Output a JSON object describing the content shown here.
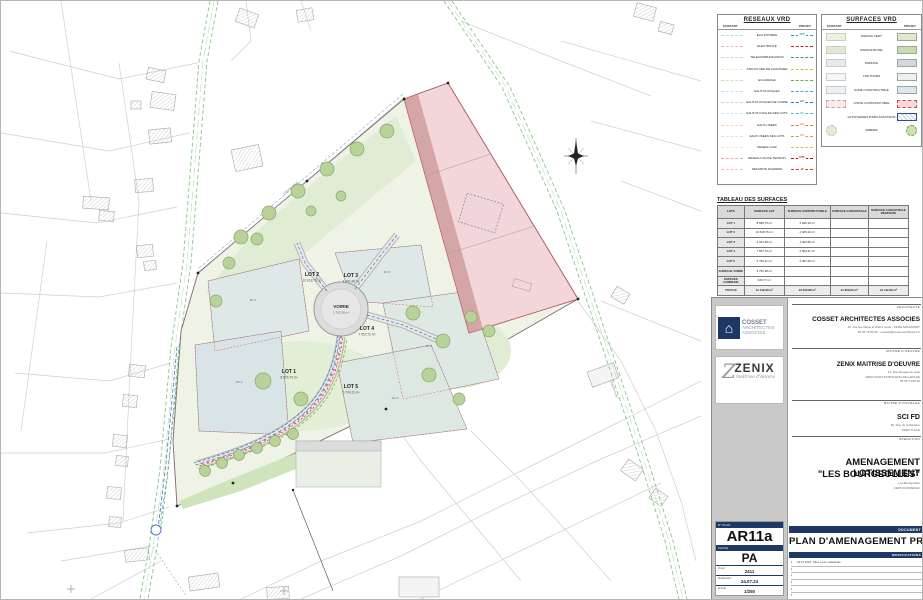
{
  "colors": {
    "navy": "#1e3866",
    "site_green": "#eef3e6",
    "pink_zone": "#f3d6da",
    "zone_blue": "#dde8e7",
    "road_green_dash": "#86c886",
    "network_blue": "#4472c4",
    "network_red": "#cc3333"
  },
  "legend_reseaux": {
    "title": "RESEAUX VRD",
    "col_existant": "EXISTANT",
    "col_projet": "PROJET",
    "rows": [
      {
        "label": "EAU POTABLE",
        "color": "#2aa198",
        "tag": "AEP"
      },
      {
        "label": "ELECTRICITE",
        "color": "#cc2222"
      },
      {
        "label": "TELECOMMUNICATION",
        "color": "#3a9d4e"
      },
      {
        "label": "STRUCTURE DE CHAUSSEE",
        "color": "#d9bb35"
      },
      {
        "label": "ECLAIRAGE",
        "color": "#56b54a"
      },
      {
        "label": "EAUX PLUVIALES",
        "color": "#5b9bd5"
      },
      {
        "label": "EAUX PLUVIALES DE VOIRIE",
        "color": "#2e75b6",
        "tag": "EP"
      },
      {
        "label": "EAUX PLUVIALES DES LOTS",
        "color": "#3ec6d8",
        "tag": "EP"
      },
      {
        "label": "EAUX USEES",
        "color": "#e67e22",
        "tag": "EU"
      },
      {
        "label": "EAUX USEES DES LOTS",
        "color": "#c8a23c",
        "tag": "EU"
      },
      {
        "label": "RESEAU GAZ",
        "color": "#c9c93a"
      },
      {
        "label": "RESEAU HAUTE TENSION",
        "color": "#c00000",
        "tag": "HTA"
      },
      {
        "label": "SECURITE INCENDIE",
        "color": "#e03030",
        "tag": "BI"
      }
    ]
  },
  "legend_surfaces": {
    "title": "SURFACES VRD",
    "col_existant": "EXISTANT",
    "col_projet": "PROJET",
    "rows": [
      {
        "label": "ESPACE VERT"
      },
      {
        "label": "ESPACE BOISE"
      },
      {
        "label": "PARKING"
      },
      {
        "label": "TROTTOIRS"
      },
      {
        "label": "ZONE CONSTRUCTIBLE"
      },
      {
        "label": "LIMITE CONSTRUCTIBLE"
      },
      {
        "label": "HYPOTHESES D'IMPLANTATIONS"
      },
      {
        "label": "ARBRES"
      }
    ]
  },
  "table": {
    "title": "TABLEAU DES SURFACES",
    "headers": [
      "LOTS",
      "SURFACE LOT",
      "SURFACE CONSTRUCTIBLE",
      "SURFACE CADASTRALE",
      "SURFACE CADASTRALE RESTANTE"
    ],
    "rows": [
      [
        "LOT 1",
        "8 595,75 m²",
        "2 936,20 m²",
        "",
        ""
      ],
      [
        "LOT 2",
        "10 618,75 m²",
        "2 925,23 m²",
        "",
        ""
      ],
      [
        "LOT 3",
        "4 347,48 m²",
        "1 363,58 m²",
        "",
        ""
      ],
      [
        "LOT 4",
        "7 657,72 m²",
        "2 553,21 m²",
        "",
        ""
      ],
      [
        "LOT 5",
        "5 794,11 m²",
        "2 257,66 m²",
        "",
        ""
      ],
      [
        "SURFACE VOIRIE",
        "3 752,38 m²",
        "",
        "",
        ""
      ],
      [
        "ESPACES COMMUNS",
        "646,77 m²",
        "",
        "",
        ""
      ]
    ],
    "total": [
      "TOTAUX",
      "41 412,96 m²",
      "12 035,88 m²",
      "41 829,00 m²",
      "41 412,96 m²"
    ]
  },
  "plan": {
    "road_label": "Chemin rural",
    "voirie": {
      "name": "VOIRIE",
      "area": "3 752,38 m²"
    },
    "lots": [
      {
        "name": "LOT 1",
        "area": "8 595,75 m²"
      },
      {
        "name": "LOT 2",
        "area": "10 618,75 m²"
      },
      {
        "name": "LOT 3",
        "area": "4 347,48 m²"
      },
      {
        "name": "LOT 4",
        "area": "7 657,72 m²"
      },
      {
        "name": "LOT 5",
        "area": "5 794,11 m²"
      }
    ],
    "zones": [
      "ZC 1",
      "ZC 2",
      "ZC 3",
      "ZC 4",
      "ZC 5"
    ]
  },
  "titleblock": {
    "logos": {
      "cosset_l1": "COSSET",
      "cosset_l2": "ARCHITECTES",
      "cosset_l3": "ASSOCIES",
      "house": "⌂",
      "zenix_z": "Z",
      "zenix": "ZENIX",
      "zenix_sub": "maîtrise d'œuvre"
    },
    "architecte": {
      "label": "ARCHITECTE",
      "name": "COSSET ARCHITECTES ASSOCIES",
      "line1": "16, Avenue Marie et Pierre Curie - 19360 MALEMORT",
      "line2": "05 55 79 80 30 - contact@cosset-architectes.fr"
    },
    "moe": {
      "label": "MAITRE D'OEUVRE",
      "name": "ZENIX MAITRISE D'OEUVRE",
      "line1": "14, Rue Rouget de Lisle",
      "line2": "19600 SAINT-PANTALEON-DE-LARCHE",
      "line3": "05 55 74 68 40"
    },
    "moa": {
      "label": "MAITRE D'OUVRAGE",
      "name": "SCI FD",
      "line1": "38, Rue de la Barrière",
      "line2": "19000 TULLE"
    },
    "operation": {
      "label": "OPERATION",
      "title1": "AMENAGEMENT LOTISSEMENT",
      "title2": "\"LES BOURGEOLLES\"",
      "line1": "Les Bourgeolles",
      "line2": "19270 DONZENAC"
    },
    "document": {
      "label": "DOCUMENT",
      "title": "PLAN D'AMENAGEMENT PROJET"
    },
    "modifications": {
      "label": "MODIFICATIONS",
      "rows": [
        "24.07.2024 : Mise à jour cadastrale",
        "",
        "",
        "",
        "",
        ""
      ]
    },
    "plan_number": {
      "label": "N° PLAN",
      "value": "AR11a"
    },
    "phase": {
      "label": "PHASE",
      "value": "PA"
    },
    "meta": [
      {
        "label": "Projet",
        "value": "2411"
      },
      {
        "label": "Modification",
        "value": "24.07.24"
      },
      {
        "label": "Echelle",
        "value": "1/250"
      }
    ]
  }
}
